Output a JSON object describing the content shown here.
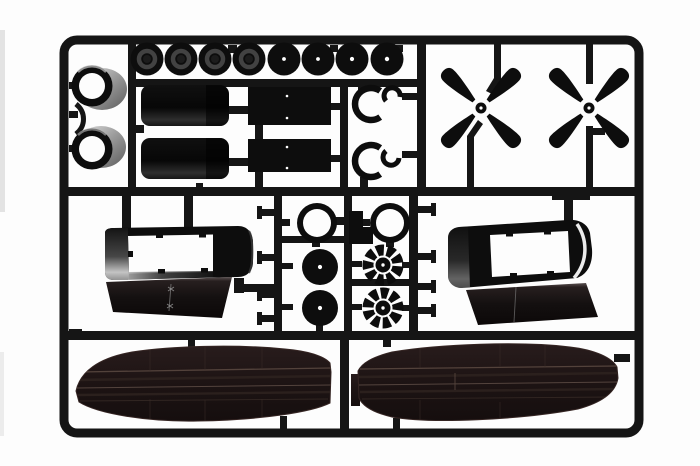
{
  "scene": {
    "type": "product-photo",
    "subject": "Injection-moulded model kit sprue (runner) of black plastic aircraft parts on white background",
    "background_color": "#fdfdfd"
  },
  "colors": {
    "sprue": "#151515",
    "part": "#0d0d0d",
    "wing": "#1d1414",
    "hub_grey": "#424242",
    "shade_grey": "#9a9a9a",
    "white": "#ffffff"
  },
  "parts": [
    {
      "name": "wheels",
      "count": 8,
      "desc": "round wheels hanging along the top rail, first four with hub rings, last four with centre pin marks"
    },
    {
      "name": "cowl-rings-left",
      "count": 2,
      "desc": "engine cowl rings with grey shaded bodies on the left rail"
    },
    {
      "name": "nacelle-cylinders",
      "count": 2,
      "desc": "rounded cylinder shell halves"
    },
    {
      "name": "flat-panels",
      "count": 2,
      "desc": "flat rectangular panels"
    },
    {
      "name": "open-c-rings",
      "count": 4,
      "desc": "open C-shaped collector rings in two pairs"
    },
    {
      "name": "propellers",
      "count": 2,
      "desc": "four-blade X-shaped propellers"
    },
    {
      "name": "centre-cowl-rings",
      "count": 2,
      "desc": "round open rings in centre box"
    },
    {
      "name": "wheel-discs",
      "count": 2,
      "desc": "solid wheel discs with centre pin marks"
    },
    {
      "name": "radial-engines",
      "count": 2,
      "desc": "finned radial engine discs"
    },
    {
      "name": "mount-bracket",
      "count": 1,
      "desc": "small L-shaped bracket"
    },
    {
      "name": "engine-nacelles",
      "count": 2,
      "desc": "nacelle shells with rectangular window openings and lower cowl flaps"
    },
    {
      "name": "wing-halves",
      "count": 2,
      "desc": "long dark wing halves with engraved panel lines along the bottom"
    }
  ]
}
